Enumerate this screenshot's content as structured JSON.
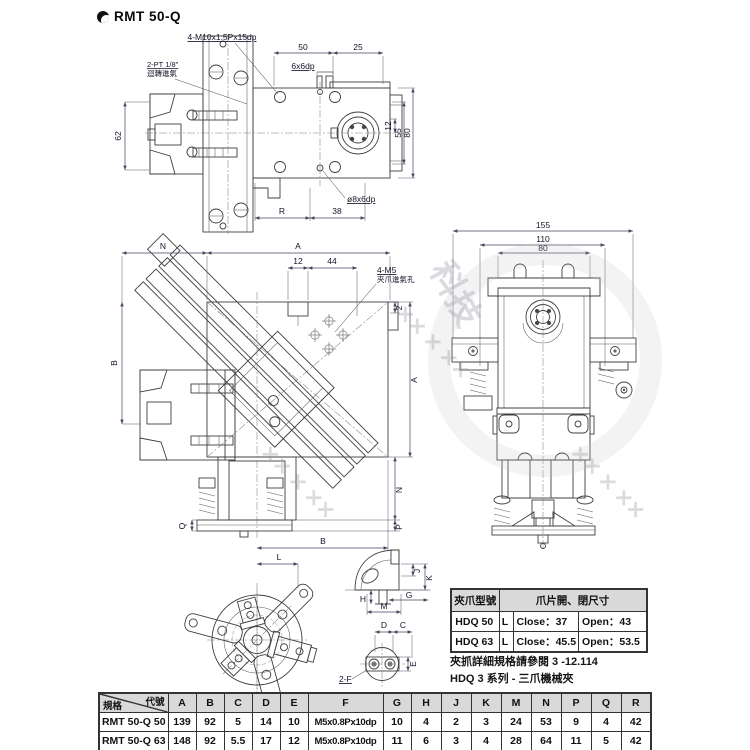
{
  "page": {
    "title": "RMT 50-Q"
  },
  "watermark": {
    "text": "科技",
    "marks": "✕✕ ✕ ✕✕"
  },
  "top_view": {
    "bolt_label": "4-M10x1.5Px15dp",
    "port_label": "2-PT 1/8\"",
    "port_label_cn": "迴轉進氣",
    "d50": "50",
    "d25": "25",
    "d6": "6x6dp",
    "d62": "62",
    "d12": "12",
    "d55": "55",
    "d80": "80",
    "dR": "R",
    "d38": "38",
    "hole_label": "ø8x6dp"
  },
  "mid_view": {
    "dN": "N",
    "dA": "A",
    "d12": "12",
    "d44": "44",
    "m5_label": "4-M5",
    "m5_cn": "夾爪進氣孔",
    "dB": "B",
    "d2": "2",
    "dA2": "A",
    "dN2": "N",
    "dP": "P",
    "dQ": "Q",
    "dB2": "B",
    "dL": "L"
  },
  "front_view": {
    "d155": "155",
    "d110": "110",
    "d80": "80"
  },
  "details": {
    "dJ": "J",
    "dK": "K",
    "dH": "H",
    "dG": "G",
    "dM": "M",
    "dD": "D",
    "dC": "C",
    "dE": "E",
    "f_label": "2-F"
  },
  "jaw_table": {
    "col_model": "夾爪型號",
    "col_size": "爪片開、閉尺寸",
    "rows": [
      {
        "model": "HDQ 50",
        "grip": "L",
        "close": "Close：37",
        "open": "Open：43"
      },
      {
        "model": "HDQ 63",
        "grip": "L",
        "close": "Close：45.5",
        "open": "Open：53.5"
      }
    ]
  },
  "notes": {
    "line1": "夾抓詳細規格請參閱 3 -12.114",
    "line2": "HDQ 3 系列 - 三爪機械夾"
  },
  "spec_table": {
    "corner_top": "代號",
    "corner_bottom": "規格",
    "columns": [
      "A",
      "B",
      "C",
      "D",
      "E",
      "F",
      "G",
      "H",
      "J",
      "K",
      "M",
      "N",
      "P",
      "Q",
      "R"
    ],
    "rows": [
      {
        "model": "RMT 50-Q 50",
        "values": [
          "139",
          "92",
          "5",
          "14",
          "10",
          "M5x0.8Px10dp",
          "10",
          "4",
          "2",
          "3",
          "24",
          "53",
          "9",
          "4",
          "42"
        ]
      },
      {
        "model": "RMT 50-Q 63",
        "values": [
          "148",
          "92",
          "5.5",
          "17",
          "12",
          "M5x0.8Px10dp",
          "11",
          "6",
          "3",
          "4",
          "28",
          "64",
          "11",
          "5",
          "42"
        ]
      }
    ]
  }
}
